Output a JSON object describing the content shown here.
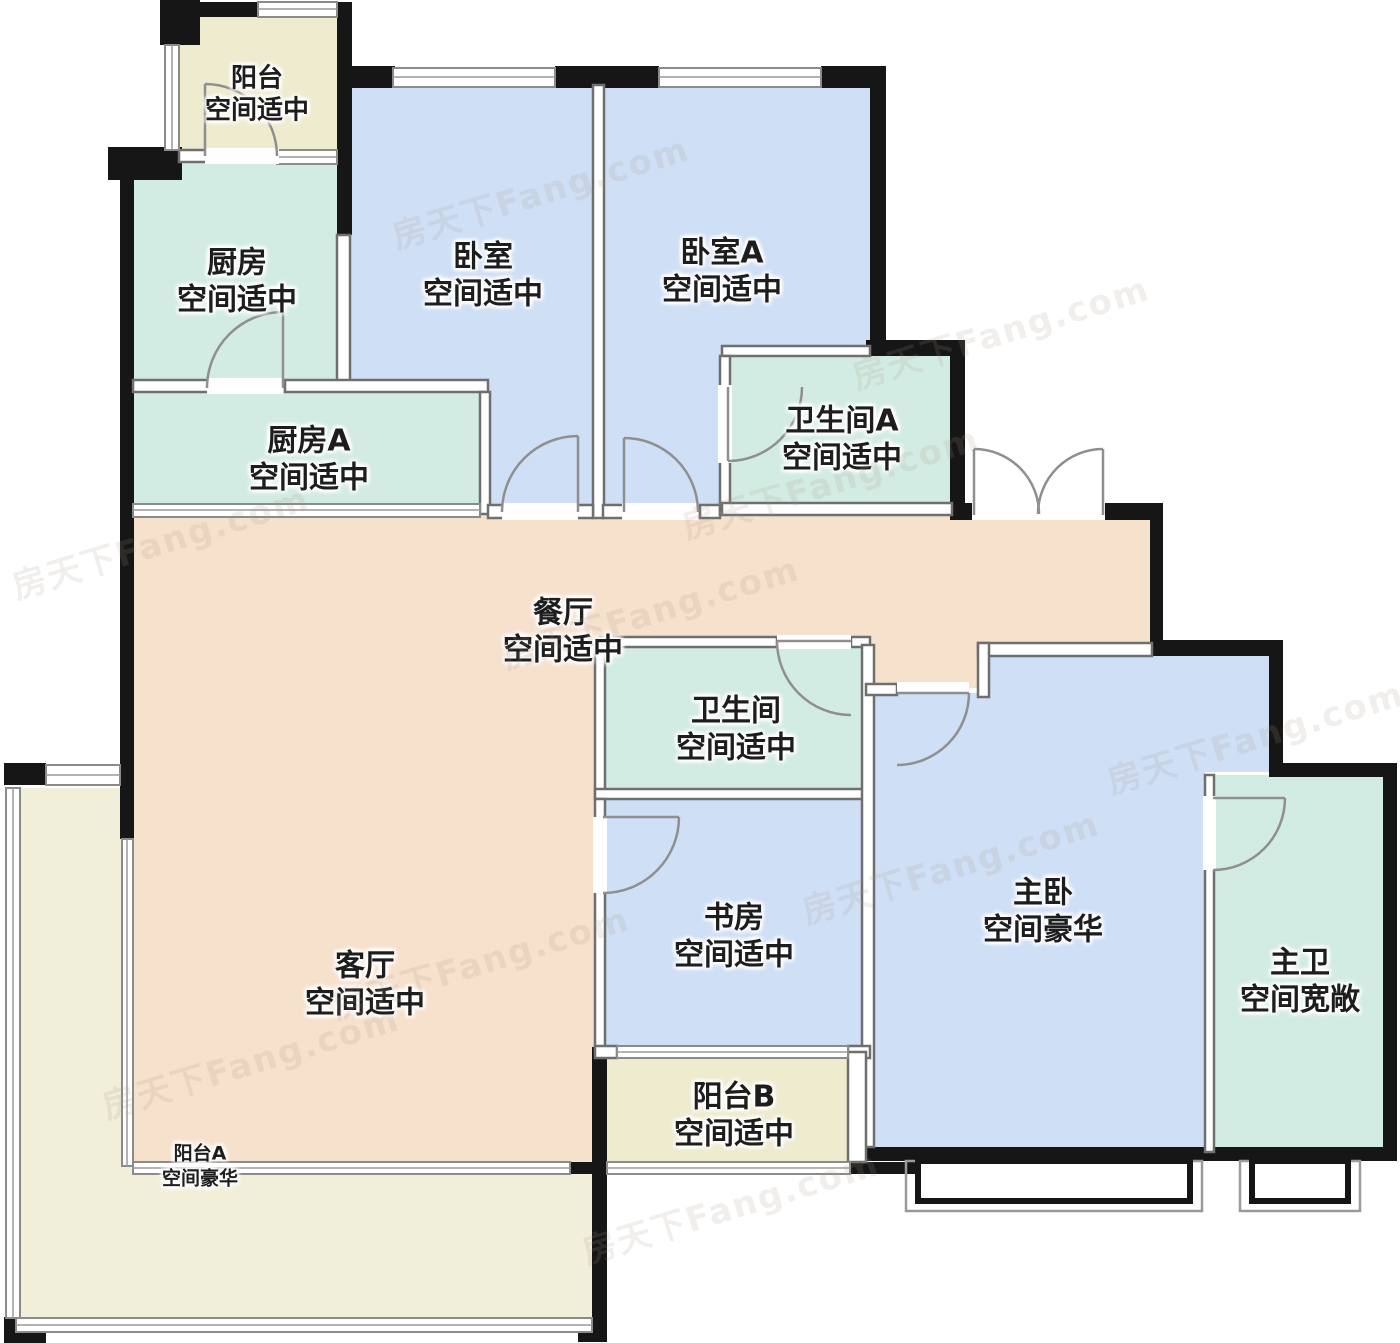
{
  "meta": {
    "title": "户型图",
    "type": "floorplan"
  },
  "watermark": {
    "text": "房天下Fang.com"
  },
  "colors": {
    "wall": "#161616",
    "room_blue": "#cfdff6",
    "room_green": "#d3ece3",
    "room_cream": "#eeebcf",
    "room_cream_light": "#f1efda",
    "room_peach": "#f6e1cd"
  },
  "rooms": {
    "balcony_top": {
      "name": "阳台",
      "note": "空间适中"
    },
    "kitchen": {
      "name": "厨房",
      "note": "空间适中"
    },
    "kitchen_a": {
      "name": "厨房A",
      "note": "空间适中"
    },
    "bedroom": {
      "name": "卧室",
      "note": "空间适中"
    },
    "bedroom_a": {
      "name": "卧室A",
      "note": "空间适中"
    },
    "bathroom_a": {
      "name": "卫生间A",
      "note": "空间适中"
    },
    "dining": {
      "name": "餐厅",
      "note": "空间适中"
    },
    "bathroom": {
      "name": "卫生间",
      "note": "空间适中"
    },
    "study": {
      "name": "书房",
      "note": "空间适中"
    },
    "balcony_b": {
      "name": "阳台B",
      "note": "空间适中"
    },
    "living": {
      "name": "客厅",
      "note": "空间适中"
    },
    "master_bedroom": {
      "name": "主卧",
      "note": "空间豪华"
    },
    "master_bath": {
      "name": "主卫",
      "note": "空间宽敞"
    },
    "balcony_a": {
      "name": "阳台A",
      "note": "空间豪华"
    }
  }
}
